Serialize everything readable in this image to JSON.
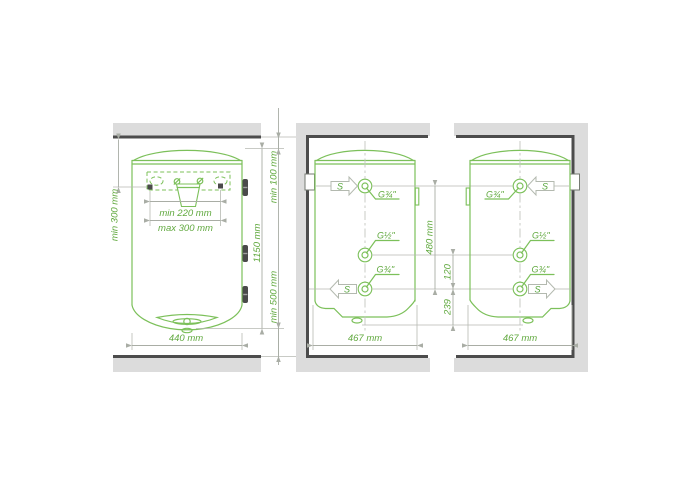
{
  "colors": {
    "line_green": "#7cc05a",
    "text_green": "#61a93f",
    "dimension_gray": "#a9ada5",
    "wall_fill": "#dcdcdc",
    "wall_edge": "#4c4c4c",
    "background": "#ffffff"
  },
  "labels": {
    "side_clearance": "min 300 mm",
    "bracket_min": "min 220 mm",
    "bracket_max": "max 300 mm",
    "front_width": "440 mm",
    "top_clearance": "min 100 mm",
    "body_height": "1150 mm",
    "bottom_clearance": "min 500 mm",
    "side_width": "467 mm",
    "connection_span": "480 mm",
    "connection_offset_middle": "120",
    "connection_offset_bottom": "239",
    "thread_34": "G¾\"",
    "thread_12": "G½\"",
    "flow_arrow": "S"
  }
}
